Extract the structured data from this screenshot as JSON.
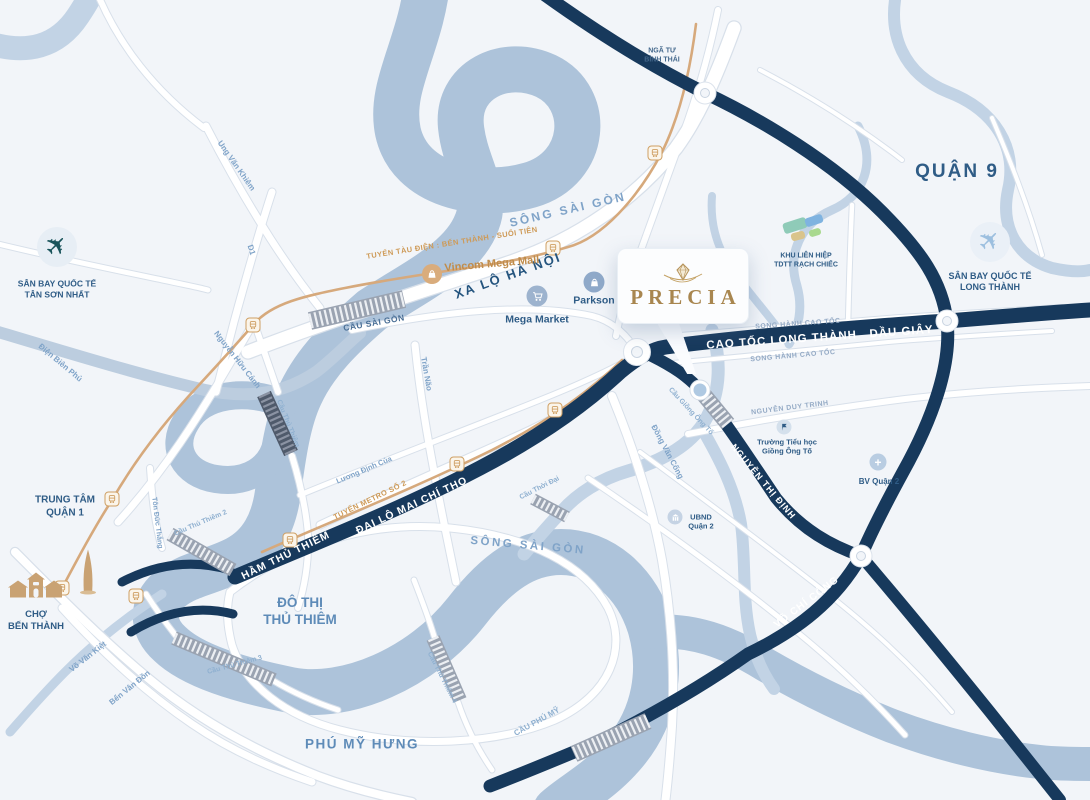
{
  "brand": {
    "name": "PRECIA"
  },
  "districts": {
    "quan_9": "QUẬN 9",
    "trung_tam_quan_1": "TRUNG TÂM\nQUẬN 1",
    "do_thi_thu_thiem": "ĐÔ THỊ\nTHỦ THIÊM",
    "phu_my_hung": "PHÚ MỸ HƯNG",
    "nga_tu_binh_thai": "NGÃ TƯ\nBÌNH THÁI"
  },
  "rivers": {
    "song_sai_gon_top": "SÔNG SÀI GÒN",
    "song_sai_gon_bottom": "SÔNG SÀI GÒN"
  },
  "highways": {
    "cao_toc_long_thanh": "CAO TỐC LONG THÀNH   DẦU GIÂY",
    "ham_thu_thiem": "HẦM THỦ THIÊM",
    "dai_lo_mai_chi_tho": "ĐẠI LỘ MAI CHÍ THỌ",
    "nguyen_thi_dinh": "NGUYỄN THỊ ĐỊNH",
    "vo_chi_cong": "VÕ CHÍ CÔNG"
  },
  "roads": {
    "xa_lo_ha_noi": "XA LỘ HÀ NỘI",
    "ung_van_khiem": "Ung Văn Khiêm",
    "d1": "D1",
    "dien_bien_phu": "Điện Biên Phủ",
    "nguyen_huu_canh": "Nguyễn Hữu Cảnh",
    "tran_nao": "Trần Não",
    "luong_dinh_cua": "Lương Định Của",
    "dong_van_cong": "Đồng Văn Cống",
    "nguyen_duy_trinh": "NGUYỄN DUY TRINH",
    "song_hanh_cao_toc_1": "SONG HÀNH CAO TỐC",
    "song_hanh_cao_toc_2": "SONG HÀNH CAO TỐC",
    "vo_van_kiet": "Võ Văn Kiệt",
    "ben_van_don": "Bến Vân Đồn",
    "ton_duc_thang": "Tôn Đức Thắng"
  },
  "transit": {
    "metro_line_1": "TUYẾN TÀU ĐIỆN : BẾN THÀNH - SUỐI TIÊN",
    "metro_line_2": "TUYẾN METRO SỐ 2"
  },
  "bridges": {
    "cau_sai_gon": "CẦU SÀI GÒN",
    "cau_thu_thiem": "Cầu Thủ Thiêm",
    "cau_thu_thiem_2": "Cầu Thủ Thiêm 2",
    "cau_thu_thiem_3": "Cầu Thủ Thiêm 3",
    "cau_thu_thiem_4": "Cầu Thủ Thiêm 4",
    "cau_phu_my": "CẦU PHÚ MỸ",
    "cau_giong_ong_to": "Cầu Giồng Ông Tố",
    "cau_thoi_dai": "Cầu Thời Đại"
  },
  "pois": {
    "vincom": "Vincom Mega Mall",
    "mega_market": "Mega Market",
    "parkson": "Parkson",
    "cho_ben_thanh": "CHỢ\nBẾN THÀNH",
    "san_bay_tan_son_nhat": "SÂN BAY QUỐC TẾ\nTÂN SƠN NHẤT",
    "san_bay_long_thanh": "SÂN BAY QUỐC TẾ\nLONG THÀNH",
    "khu_lien_hiep_tdtt": "KHU LIÊN HIỆP\nTDTT RẠCH CHIẾC",
    "truong_tieu_hoc_giong_ong_to": "Trường Tiểu học\nGiồng Ông Tố",
    "bv_quan_2": "BV Quận 2",
    "ubnd_quan_2": "UBND\nQuận 2"
  },
  "colors": {
    "navy_road": "#17395C",
    "river": "#ADC3DA",
    "creek": "#C2D3E5",
    "metro": "#D6A97C",
    "gold": "#A8864F",
    "label_navy": "#2F5C86",
    "label_blue": "#7FA3C8",
    "background": "#F2F5F9"
  }
}
